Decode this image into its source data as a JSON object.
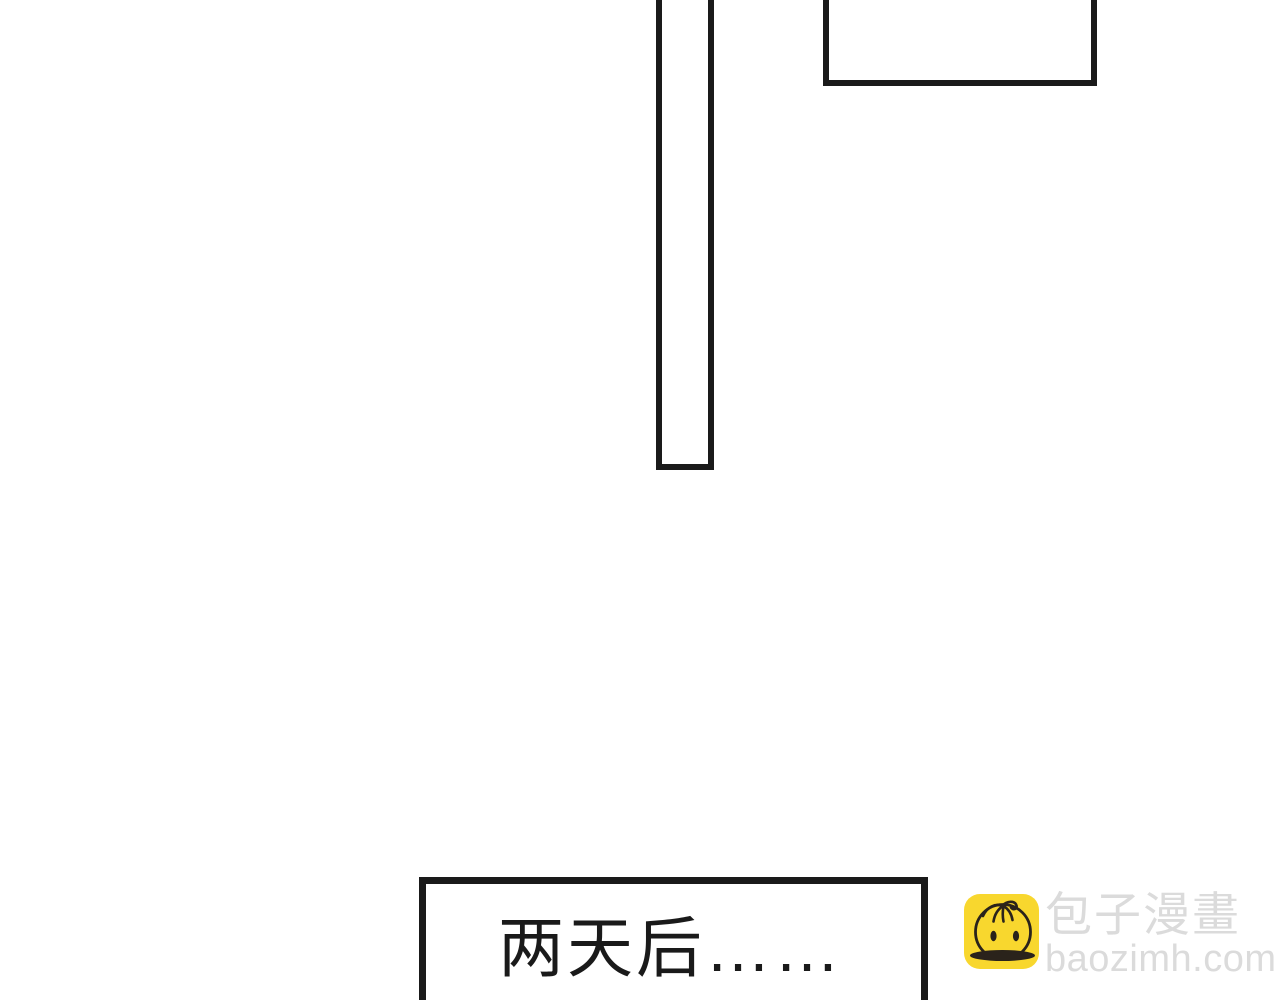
{
  "page": {
    "type": "comic-page",
    "background_color": "#ffffff",
    "panel_line_color": "#1a1a1a"
  },
  "caption": {
    "text": "两天后……",
    "text_color": "#1a1a1a"
  },
  "watermark": {
    "icon": "baozi-bun-icon",
    "icon_bg_color": "#f8d72e",
    "icon_line_color": "#2a231b",
    "site_name": "包子漫畫",
    "site_domain": "baozimh.com",
    "text_color": "#dbdbdb"
  }
}
